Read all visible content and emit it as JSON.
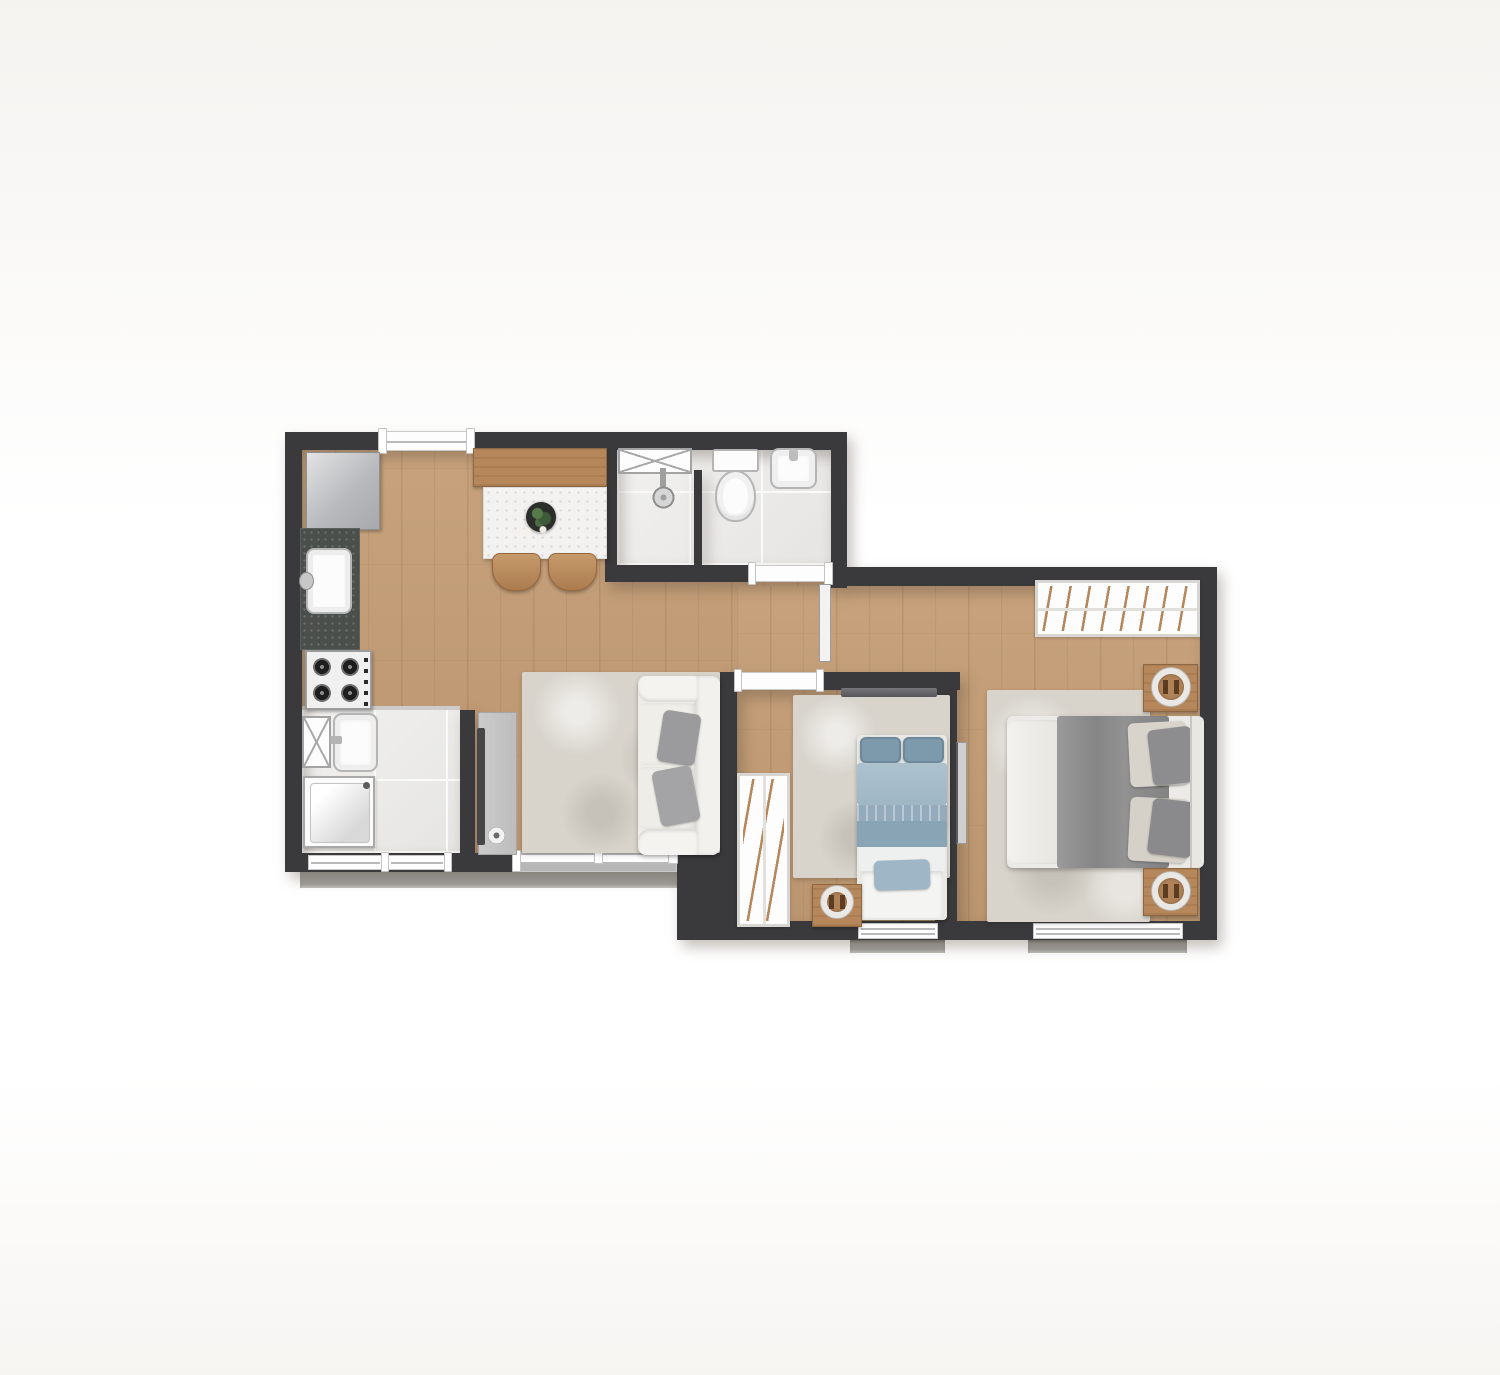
{
  "title": "apartment-floor-plan-top-view",
  "canvas": {
    "width": 1500,
    "height": 1375,
    "background": "#ffffff"
  },
  "colors": {
    "wall": "#3a3a3c",
    "wood": "#c49d75",
    "tile": "#edecea",
    "rug": "#d8d4cc",
    "ledge": "#a3a19d",
    "accent": "#b5875a",
    "marble": "#f3f2f0",
    "granite": "#4b4f4c",
    "sofa": "#edece7",
    "cushion": "#9b9b9d",
    "blue": "#7d99ac",
    "blue_light": "#adc2cf",
    "blue_dark": "#89a5b5",
    "duvet": "#8f8f90",
    "fixture": "#fcfcfc",
    "fixture_line": "#b5b5b5",
    "leaf": "#e8e8e8",
    "glass": "#b7b7b7",
    "tv": "#47474a",
    "plant_green": "#3c5a35",
    "plant_pot": "#2b2e2b",
    "fridge": "#c3c4c7",
    "steel": "#e8e8e8"
  },
  "rooms": [
    {
      "id": "kitchen",
      "name": "Kitchen",
      "floor": "wood",
      "items": [
        "refrigerator",
        "granite-countertop",
        "kitchen-sink",
        "gas-cooktop-4-burners"
      ]
    },
    {
      "id": "dining",
      "name": "Dining area",
      "floor": "wood",
      "items": [
        "wood-sideboard-bench",
        "white-stone-dining-table",
        "plant-centerpiece",
        "dining-chair",
        "dining-chair"
      ]
    },
    {
      "id": "living",
      "name": "Living room",
      "floor": "wood",
      "items": [
        "tv-panel",
        "tv",
        "area-rug",
        "two-seat-sofa",
        "throw-cushion",
        "throw-cushion"
      ]
    },
    {
      "id": "bathroom",
      "name": "Bathroom",
      "floor": "tile",
      "items": [
        "ventilation-shaft",
        "shower",
        "shower-partition",
        "toilet",
        "washbasin"
      ]
    },
    {
      "id": "service",
      "name": "Laundry / service area",
      "floor": "tile",
      "items": [
        "ventilation-shaft",
        "laundry-tank",
        "washing-machine"
      ]
    },
    {
      "id": "bedroom-single",
      "name": "Bedroom 1 (single)",
      "floor": "wood",
      "items": [
        "wardrobe",
        "single-bed-blue-bedding",
        "foot-bench-with-cushion",
        "nightstand",
        "round-lamp",
        "area-rug",
        "curtain-rail"
      ]
    },
    {
      "id": "bedroom-couple",
      "name": "Bedroom 2 (couple)",
      "floor": "wood",
      "items": [
        "wardrobe",
        "double-bed-gray-duvet",
        "nightstand",
        "nightstand",
        "round-lamp",
        "round-lamp",
        "area-rug"
      ]
    }
  ],
  "openings": [
    {
      "id": "entry-door",
      "wall": "top",
      "type": "door"
    },
    {
      "id": "service-window-1",
      "wall": "bottom-left",
      "type": "window"
    },
    {
      "id": "service-window-2",
      "wall": "bottom-left",
      "type": "window"
    },
    {
      "id": "living-sliding-door",
      "wall": "bottom-left",
      "type": "sliding-glass-door"
    },
    {
      "id": "bathroom-door",
      "wall": "bathroom-bottom",
      "type": "door-with-leaf"
    },
    {
      "id": "bedroom-single-door",
      "wall": "bedroom-top",
      "type": "door-with-leaf"
    },
    {
      "id": "bedroom-couple-door",
      "wall": "bedroom-partition",
      "type": "door-with-leaf"
    },
    {
      "id": "bedroom-single-window",
      "wall": "bottom-right",
      "type": "window"
    },
    {
      "id": "bedroom-couple-window",
      "wall": "bottom-right",
      "type": "window"
    }
  ]
}
